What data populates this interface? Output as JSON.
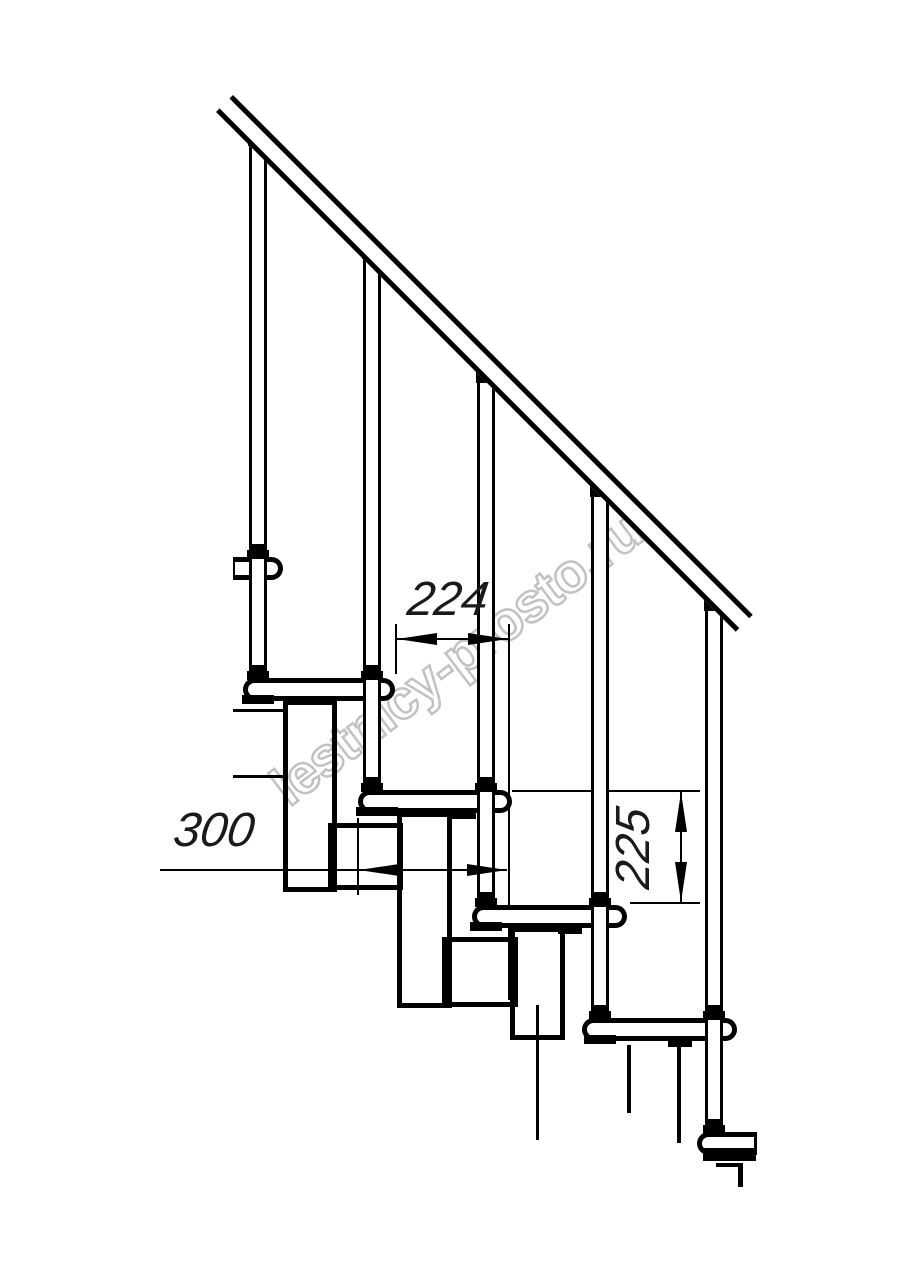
{
  "meta": {
    "type": "technical-drawing",
    "subject": "modular staircase side elevation fragment",
    "style": "black line CAD drawing on white"
  },
  "colors": {
    "line": "#000000",
    "background": "#ffffff",
    "watermark": "#c2c2c2",
    "dimension_text": "#1a1a1a"
  },
  "watermark": {
    "text": "lestnicy-prosto.ru"
  },
  "dimensions": {
    "step_run": {
      "label": "224",
      "orientation": "horizontal"
    },
    "tread_depth": {
      "label": "300",
      "orientation": "horizontal"
    },
    "step_rise": {
      "label": "225",
      "orientation": "vertical"
    }
  },
  "drawing": {
    "balusters_count": 5,
    "treads_visible": 6,
    "handrail_angle_deg": 45
  }
}
